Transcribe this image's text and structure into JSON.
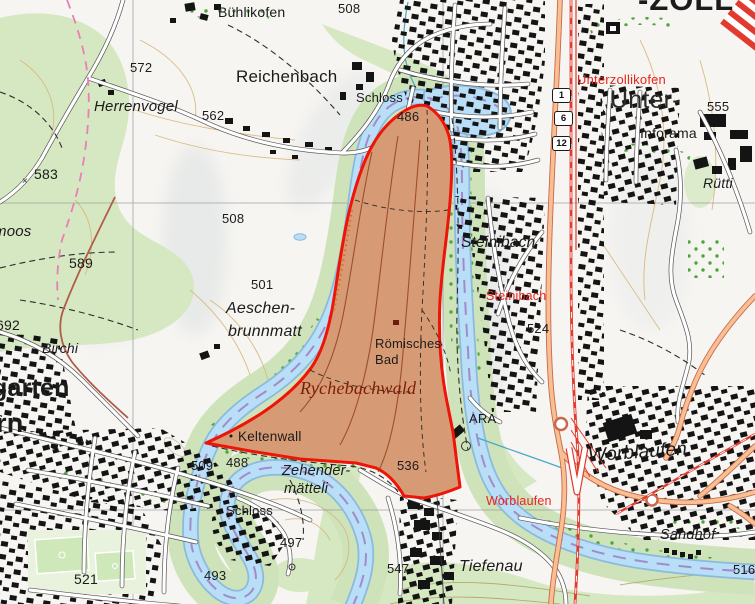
{
  "map": {
    "type": "swiss-topographic-map",
    "description": "Topographic map of the Aare river loop with highlighted Rychebachwald perimeter",
    "highlight_area": {
      "name": "Rychebachwald",
      "outline_color": "#ee1408",
      "fill_color": "rgba(224,86,52,0.5)"
    },
    "colors": {
      "river": "#b9def8",
      "river_edge": "#8bbade",
      "waterway_route_dash": "#a08cc8",
      "forest": "#d6e8c2",
      "contour": "#d9b77d",
      "main_road": "#f7bf92",
      "railway": "#e13b2f",
      "station_label": "#e8251f",
      "building": "#141414"
    },
    "route_shields": {
      "s1": "1",
      "s6": "6",
      "s12": "12"
    },
    "labels": {
      "buehlikofen": {
        "text": "Bühlikofen"
      },
      "spot508a": {
        "text": "508"
      },
      "zoll": {
        "text": "-ZOLL"
      },
      "spot572": {
        "text": "572"
      },
      "reichenbach": {
        "text": "Reichenbach"
      },
      "herrenvogel": {
        "text": "Herrenvogel"
      },
      "spot562": {
        "text": "562"
      },
      "schloss_n": {
        "text": "Schloss"
      },
      "spot486": {
        "text": "486"
      },
      "unterzollikofen": {
        "text": "Unterzollikofen"
      },
      "unter": {
        "text": "Unter-"
      },
      "spot555": {
        "text": "555"
      },
      "inforama": {
        "text": "Inforama"
      },
      "ruetti": {
        "text": "Rütti"
      },
      "spot583": {
        "text": "583"
      },
      "xmark583": {
        "text": "×"
      },
      "moos": {
        "text": "moos"
      },
      "spot508b": {
        "text": "508"
      },
      "steinibach": {
        "text": "Steinibach"
      },
      "steinibach_stn": {
        "text": "Steinibach"
      },
      "spot589": {
        "text": "589"
      },
      "spot501": {
        "text": "501"
      },
      "aeschen1": {
        "text": "Aeschen-"
      },
      "aeschen2": {
        "text": "brunnmatt"
      },
      "spot524": {
        "text": "524"
      },
      "roemisches1": {
        "text": "Römisches"
      },
      "roemisches2": {
        "text": "Bad"
      },
      "rychebachwald": {
        "text": "Rychebachwald"
      },
      "spot692": {
        "text": "692"
      },
      "birchi": {
        "text": "Birchi"
      },
      "garten": {
        "text": "garten"
      },
      "rn": {
        "text": "rn"
      },
      "ara": {
        "text": "ARA"
      },
      "worblaufen": {
        "text": "Worblaufen"
      },
      "worblaufen_stn": {
        "text": "Worblaufen"
      },
      "keltenwall": {
        "text": "Keltenwall"
      },
      "spot509": {
        "text": "509"
      },
      "spot488": {
        "text": "488"
      },
      "zehender1": {
        "text": "Zehender-"
      },
      "zehender2": {
        "text": "mätteli"
      },
      "spot536": {
        "text": "536"
      },
      "sandhof": {
        "text": "Sandhof"
      },
      "schloss_s": {
        "text": "Schloss"
      },
      "spot497": {
        "text": "497"
      },
      "spot493": {
        "text": "493"
      },
      "spot547": {
        "text": "547"
      },
      "tiefenau": {
        "text": "Tiefenau"
      },
      "spot521": {
        "text": "521"
      },
      "spot516": {
        "text": "516"
      }
    }
  }
}
